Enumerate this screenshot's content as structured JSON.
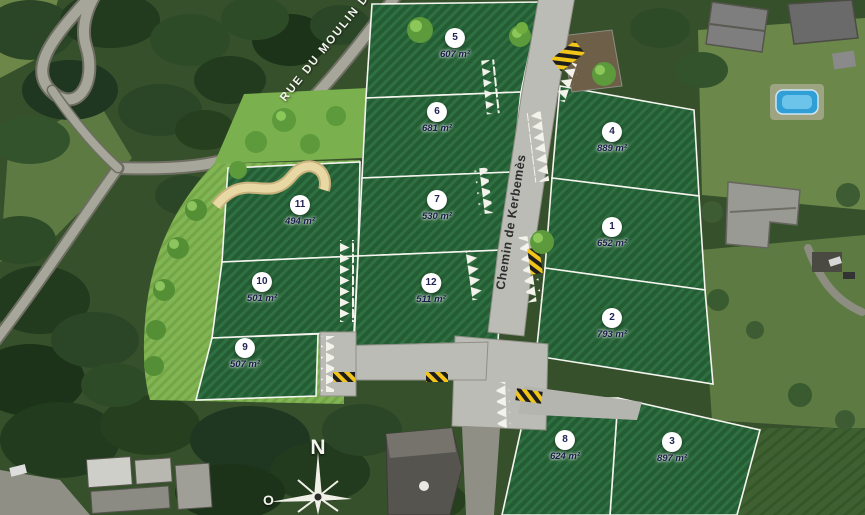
{
  "map": {
    "streets": {
      "top_road": "RUE DU MOULIN D",
      "main_road": "Chemin de Kerbemès"
    },
    "compass": {
      "north": "N",
      "west": "O"
    },
    "plots": [
      {
        "number": "1",
        "area": "652 m²"
      },
      {
        "number": "2",
        "area": "793 m²"
      },
      {
        "number": "3",
        "area": "897 m²"
      },
      {
        "number": "4",
        "area": "889 m²"
      },
      {
        "number": "5",
        "area": "607 m²"
      },
      {
        "number": "6",
        "area": "681 m²"
      },
      {
        "number": "7",
        "area": "530 m²"
      },
      {
        "number": "8",
        "area": "624 m²"
      },
      {
        "number": "9",
        "area": "507 m²"
      },
      {
        "number": "10",
        "area": "501 m²"
      },
      {
        "number": "11",
        "area": "494 m²"
      },
      {
        "number": "12",
        "area": "511 m²"
      }
    ],
    "colors": {
      "plot_green": "#245c33",
      "plot_green_stripe": "#2f7042",
      "landscape_green": "#82b553",
      "road_gray": "#bcbcb6",
      "hazard_yellow": "#f0c419",
      "marker_text": "#232355"
    }
  }
}
